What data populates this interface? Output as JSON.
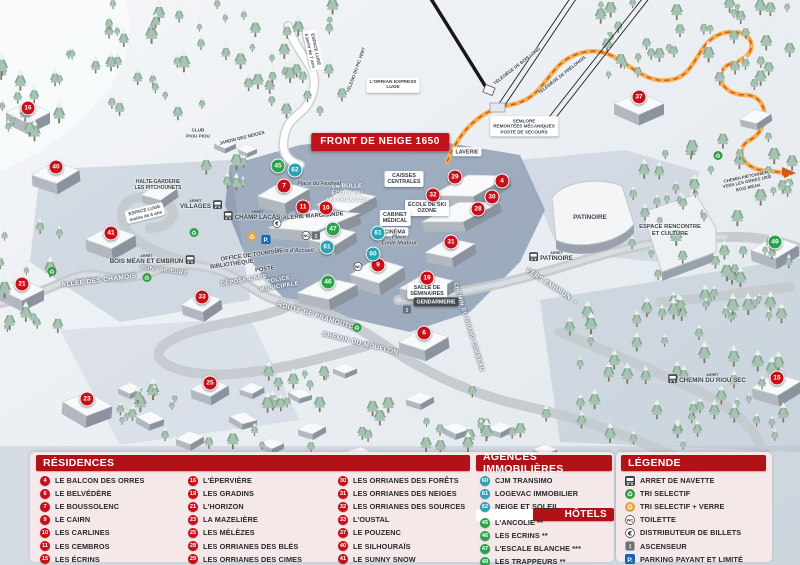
{
  "map": {
    "banner": "FRONT DE NEIGE 1650",
    "arret_label": "ARRÊT",
    "markers": [
      {
        "n": "16",
        "type": "residence",
        "x": 28,
        "y": 108
      },
      {
        "n": "40",
        "type": "residence",
        "x": 56,
        "y": 167
      },
      {
        "n": "41",
        "type": "residence",
        "x": 111,
        "y": 233
      },
      {
        "n": "21",
        "type": "residence",
        "x": 22,
        "y": 284
      },
      {
        "n": "33",
        "type": "residence",
        "x": 202,
        "y": 297
      },
      {
        "n": "23",
        "type": "residence",
        "x": 87,
        "y": 399
      },
      {
        "n": "25",
        "type": "residence",
        "x": 210,
        "y": 383
      },
      {
        "n": "7",
        "type": "residence",
        "x": 284,
        "y": 186
      },
      {
        "n": "11",
        "type": "residence",
        "x": 303,
        "y": 207
      },
      {
        "n": "10",
        "type": "residence",
        "x": 326,
        "y": 208
      },
      {
        "n": "9",
        "type": "residence",
        "x": 378,
        "y": 265
      },
      {
        "n": "29",
        "type": "residence",
        "x": 455,
        "y": 177
      },
      {
        "n": "4",
        "type": "residence",
        "x": 502,
        "y": 181
      },
      {
        "n": "32",
        "type": "residence",
        "x": 433,
        "y": 195
      },
      {
        "n": "30",
        "type": "residence",
        "x": 492,
        "y": 197
      },
      {
        "n": "28",
        "type": "residence",
        "x": 478,
        "y": 209
      },
      {
        "n": "31",
        "type": "residence",
        "x": 451,
        "y": 242
      },
      {
        "n": "19",
        "type": "residence",
        "x": 427,
        "y": 278
      },
      {
        "n": "6",
        "type": "residence",
        "x": 424,
        "y": 333
      },
      {
        "n": "37",
        "type": "residence",
        "x": 639,
        "y": 97
      },
      {
        "n": "15",
        "type": "residence",
        "x": 777,
        "y": 378
      },
      {
        "n": "62",
        "type": "agence",
        "x": 295,
        "y": 170
      },
      {
        "n": "61",
        "type": "agence",
        "x": 378,
        "y": 233
      },
      {
        "n": "61",
        "type": "agence",
        "x": 327,
        "y": 247
      },
      {
        "n": "60",
        "type": "agence",
        "x": 373,
        "y": 254
      },
      {
        "n": "45",
        "type": "hotel",
        "x": 278,
        "y": 166
      },
      {
        "n": "47",
        "type": "hotel",
        "x": 333,
        "y": 229
      },
      {
        "n": "46",
        "type": "hotel",
        "x": 328,
        "y": 282
      },
      {
        "n": "49",
        "type": "hotel",
        "x": 775,
        "y": 242
      }
    ],
    "labels": [
      {
        "style": "box",
        "lines": [
          "SEMLORE",
          "REMONTÉES MÉCANIQUES",
          "POSTE DE SECOURS"
        ],
        "x": 524,
        "y": 126,
        "size": 4.6
      },
      {
        "style": "box",
        "lines": [
          "LAVERIE"
        ],
        "x": 467,
        "y": 152
      },
      {
        "style": "box",
        "lines": [
          "CAISSES",
          "CENTRALES"
        ],
        "x": 404,
        "y": 179
      },
      {
        "style": "white",
        "lines": [
          "LA BULLE",
          "ÉCOLE DU",
          "SKI FRANÇAIS"
        ],
        "x": 347,
        "y": 194
      },
      {
        "style": "box",
        "lines": [
          "ÉCOLE DE SKI",
          "OZONE"
        ],
        "x": 427,
        "y": 208
      },
      {
        "style": "dark",
        "lines": [
          "GALERIE MARCHANDE"
        ],
        "x": 311,
        "y": 217,
        "rot": -4
      },
      {
        "style": "box",
        "lines": [
          "CABINET",
          "MÉDICAL"
        ],
        "x": 395,
        "y": 218
      },
      {
        "style": "box",
        "lines": [
          "CINÉMA"
        ],
        "x": 395,
        "y": 232
      },
      {
        "style": "italic",
        "lines": [
          "Place du Festival"
        ],
        "x": 319,
        "y": 184
      },
      {
        "style": "italic",
        "lines": [
          "Place d'Accueil"
        ],
        "x": 294,
        "y": 251
      },
      {
        "style": "italic",
        "lines": [
          "Place",
          "Émile Modout"
        ],
        "x": 399,
        "y": 241
      },
      {
        "style": "dark",
        "lines": [
          "OFFICE DE TOURISME"
        ],
        "x": 252,
        "y": 256,
        "rot": -8
      },
      {
        "style": "dark",
        "lines": [
          "BIBLIOTHÈQUE"
        ],
        "x": 232,
        "y": 265,
        "rot": -8
      },
      {
        "style": "dark",
        "lines": [
          "POSTE"
        ],
        "x": 265,
        "y": 270,
        "rot": -8
      },
      {
        "style": "road",
        "lines": [
          "DÉPOSE CARS"
        ],
        "x": 244,
        "y": 281,
        "rot": -10,
        "size": 5.8
      },
      {
        "style": "road",
        "lines": [
          "POLICE",
          "MUNICIPALE"
        ],
        "x": 279,
        "y": 284,
        "rot": -10,
        "size": 5.8
      },
      {
        "style": "box",
        "lines": [
          "SALLE DE",
          "SÉMINAIRES"
        ],
        "x": 427,
        "y": 291
      },
      {
        "style": "darkbox",
        "lines": [
          "GENDARMERIE"
        ],
        "x": 436,
        "y": 302
      },
      {
        "style": "dark",
        "lines": [
          "PATINOIRE"
        ],
        "x": 590,
        "y": 218,
        "size": 6.4
      },
      {
        "style": "dark",
        "lines": [
          "ESPACE RENCONTRE",
          "ET CULTURE"
        ],
        "x": 670,
        "y": 231
      },
      {
        "style": "road",
        "lines": [
          "VERS EMBRUN →"
        ],
        "x": 552,
        "y": 287,
        "rot": 33
      },
      {
        "style": "road",
        "lines": [
          "CHEMIN DU GRAND CORBEAU"
        ],
        "x": 468,
        "y": 327,
        "rot": 73,
        "size": 5.6
      },
      {
        "style": "road",
        "lines": [
          "CHEMIN DU MOUFLON"
        ],
        "x": 360,
        "y": 344,
        "rot": 14
      },
      {
        "style": "road",
        "lines": [
          "ROUTE DE PRAMOUTON"
        ],
        "x": 318,
        "y": 317,
        "rot": 17
      },
      {
        "style": "road",
        "lines": [
          "ALLÉE DES CHAMOIS"
        ],
        "x": 99,
        "y": 281,
        "rot": -7
      },
      {
        "style": "road",
        "lines": [
          "PONT SKIEURS"
        ],
        "x": 164,
        "y": 271,
        "rot": 8,
        "size": 5.6
      },
      {
        "style": "dark",
        "lines": [
          "CHEMIN PIÉTONNIER",
          "VERS LES ORRES 1800",
          "BOIS MÉAN"
        ],
        "x": 747,
        "y": 182,
        "rot": -12,
        "size": 4.4
      },
      {
        "style": "dark",
        "lines": [
          "HALTE-GARDERIE",
          "LES PITCHOUNETS"
        ],
        "x": 158,
        "y": 185,
        "size": 5
      },
      {
        "style": "dark",
        "lines": [
          "CLUB",
          "PIOU PIOU"
        ],
        "x": 198,
        "y": 133,
        "size": 4.6
      },
      {
        "style": "dark",
        "lines": [
          "JARDIN DES NEIGES"
        ],
        "x": 242,
        "y": 138,
        "rot": -14,
        "size": 4.6
      },
      {
        "style": "sign",
        "lines": [
          "ESPACE LUGE",
          "à partir de 7 ans"
        ],
        "x": 313,
        "y": 50,
        "rot": 78
      },
      {
        "style": "sign",
        "lines": [
          "ESPACE LUGE",
          "moins de 6 ans"
        ],
        "x": 145,
        "y": 213,
        "rot": -14
      },
      {
        "style": "box",
        "lines": [
          "L'ORRIAN EXPRESS",
          "LUGE"
        ],
        "x": 393,
        "y": 85,
        "size": 4.8
      },
      {
        "style": "dark",
        "lines": [
          "TÉLÉSKI DU PIC VERT"
        ],
        "x": 356,
        "y": 70,
        "rot": -70,
        "size": 4.4
      },
      {
        "style": "dark",
        "lines": [
          "TÉLÉSIÈGE DE BOIS LONG"
        ],
        "x": 517,
        "y": 66,
        "rot": -38,
        "size": 4.4
      },
      {
        "style": "dark",
        "lines": [
          "TÉLÉSIÈGE DE PRÉLONGIS"
        ],
        "x": 562,
        "y": 75,
        "rot": -38,
        "size": 4.4
      }
    ],
    "stops": [
      {
        "label": "VILLAGES",
        "x": 201,
        "y": 205,
        "side": "right"
      },
      {
        "label": "CHAMP LACAS",
        "x": 252,
        "y": 216,
        "side": "left"
      },
      {
        "label": "BOIS MÉAN ET EMBRUN",
        "x": 152,
        "y": 260,
        "side": "right"
      },
      {
        "label": "PATINOIRE",
        "x": 551,
        "y": 257,
        "side": "left"
      },
      {
        "label": "CHEMIN DU RIOU SEC",
        "x": 707,
        "y": 379,
        "side": "left"
      }
    ],
    "icons": [
      {
        "type": "recycle-green",
        "x": 147,
        "y": 278
      },
      {
        "type": "recycle-green",
        "x": 194,
        "y": 233
      },
      {
        "type": "recycle-green",
        "x": 357,
        "y": 328
      },
      {
        "type": "recycle-green",
        "x": 718,
        "y": 156
      },
      {
        "type": "recycle-green",
        "x": 52,
        "y": 272
      },
      {
        "type": "recycle-yellow",
        "x": 252,
        "y": 237
      },
      {
        "type": "parking",
        "x": 266,
        "y": 240
      },
      {
        "type": "eur",
        "x": 277,
        "y": 224
      },
      {
        "type": "wc",
        "x": 306,
        "y": 236
      },
      {
        "type": "elevator",
        "x": 316,
        "y": 236
      },
      {
        "type": "elevator",
        "x": 407,
        "y": 310
      },
      {
        "type": "wc",
        "x": 358,
        "y": 267
      }
    ]
  },
  "legend": {
    "residences": {
      "title": "RÉSIDENCES",
      "items": [
        {
          "n": "4",
          "label": "LE BALCON DES ORRES"
        },
        {
          "n": "6",
          "label": "LE BELVÉDÈRE"
        },
        {
          "n": "7",
          "label": "LE BOUSSOLENC"
        },
        {
          "n": "9",
          "label": "LE CAIRN"
        },
        {
          "n": "10",
          "label": "LES CARLINES"
        },
        {
          "n": "11",
          "label": "LES CEMBROS"
        },
        {
          "n": "15",
          "label": "LES ÉCRINS"
        },
        {
          "n": "16",
          "label": "L'ÉPERVIÈRE"
        },
        {
          "n": "19",
          "label": "LES GRADINS"
        },
        {
          "n": "21",
          "label": "L'HORIZON"
        },
        {
          "n": "23",
          "label": "LA MAZELIÈRE"
        },
        {
          "n": "25",
          "label": "LES MÉLÈZES"
        },
        {
          "n": "28",
          "label": "LES ORRIANES DES BLÉS"
        },
        {
          "n": "29",
          "label": "LES ORRIANES DES CIMES"
        },
        {
          "n": "30",
          "label": "LES ORRIANES DES FORÊTS"
        },
        {
          "n": "31",
          "label": "LES ORRIANES DES NEIGES"
        },
        {
          "n": "32",
          "label": "LES ORRIANES DES SOURCES"
        },
        {
          "n": "33",
          "label": "L'OUSTAL"
        },
        {
          "n": "37",
          "label": "LE POUZENC"
        },
        {
          "n": "40",
          "label": "LE SILHOURAÏS"
        },
        {
          "n": "41",
          "label": "LE SUNNY SNOW"
        }
      ]
    },
    "agences": {
      "title": "AGENCES IMMOBILIÈRES",
      "items": [
        {
          "n": "60",
          "label": "CJM TRANSIMO"
        },
        {
          "n": "61",
          "label": "LOGEVAC IMMOBILIER"
        },
        {
          "n": "62",
          "label": "NEIGE ET SOLEIL"
        }
      ]
    },
    "hotels": {
      "title": "HÔTELS",
      "items": [
        {
          "n": "45",
          "label": "L'ANCOLIE **"
        },
        {
          "n": "46",
          "label": "LES ECRINS **"
        },
        {
          "n": "47",
          "label": "L'ESCALE BLANCHE ***"
        },
        {
          "n": "49",
          "label": "LES TRAPPEURS **"
        }
      ]
    },
    "legende": {
      "title": "LÉGENDE",
      "items": [
        {
          "icon": "bus",
          "label": "ARRET DE NAVETTE"
        },
        {
          "icon": "recycle-green",
          "label": "TRI SELECTIF"
        },
        {
          "icon": "recycle-yellow",
          "label": "TRI SELECTIF + VERRE"
        },
        {
          "icon": "wc",
          "label": "TOILETTE"
        },
        {
          "icon": "eur",
          "label": "DISTRIBUTEUR DE BILLETS"
        },
        {
          "icon": "elevator",
          "label": "ASCENSEUR"
        },
        {
          "icon": "parking",
          "label": "PARKING PAYANT ET LIMITÉ"
        }
      ]
    }
  },
  "colors": {
    "header_red": "#b01217",
    "banner_red": "#c01218",
    "residence": "#c8101b",
    "agence": "#2aa3b4",
    "hotel": "#2aa24b",
    "path_orange": "#d35b15"
  }
}
